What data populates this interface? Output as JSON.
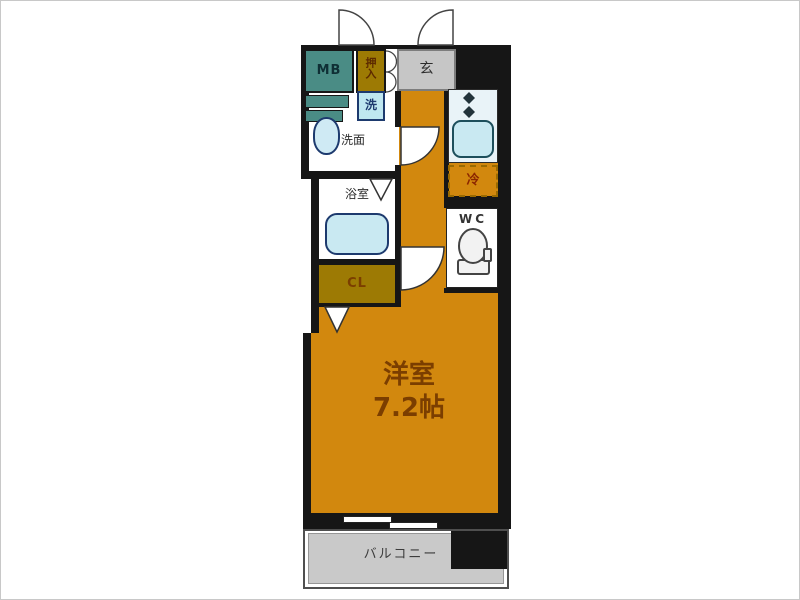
{
  "plan": {
    "title": "apartment-floor-plan-1k",
    "rooms": {
      "main_room": {
        "name": "洋室",
        "size": "7.2帖"
      },
      "balcony": {
        "label": "バルコニー"
      },
      "entrance": {
        "label": "玄"
      },
      "washroom": {
        "label": "洗面"
      },
      "bathroom": {
        "label": "浴室"
      },
      "toilet": {
        "label": "WC"
      },
      "closet": {
        "label": "CL"
      },
      "storage": {
        "label": "押入"
      },
      "meter_box": {
        "label": "MB"
      },
      "laundry": {
        "label": "洗"
      },
      "fridge": {
        "label": "冷"
      }
    },
    "colors": {
      "floor_orange": "#d2880e",
      "closet_olive": "#9d7a04",
      "meter_box_teal": "#4a8c85",
      "fixture_blue": "#c9e9f2",
      "counter_blue": "#e9f3f8",
      "entrance_gray": "#c6c6c6",
      "balcony_gray": "#c9c9c9",
      "wall_black": "#161616",
      "room_label_brown": "#7b3e00"
    },
    "icons": {
      "door_swing": "quarter-circle-arc",
      "double_door": "half-circle-arcs",
      "folding_door": "v-triangle",
      "toilet_bowl": "bowl-outline",
      "stove_burner": "diamond-dots",
      "bathtub": "rounded-rect",
      "sink": "oval"
    }
  }
}
